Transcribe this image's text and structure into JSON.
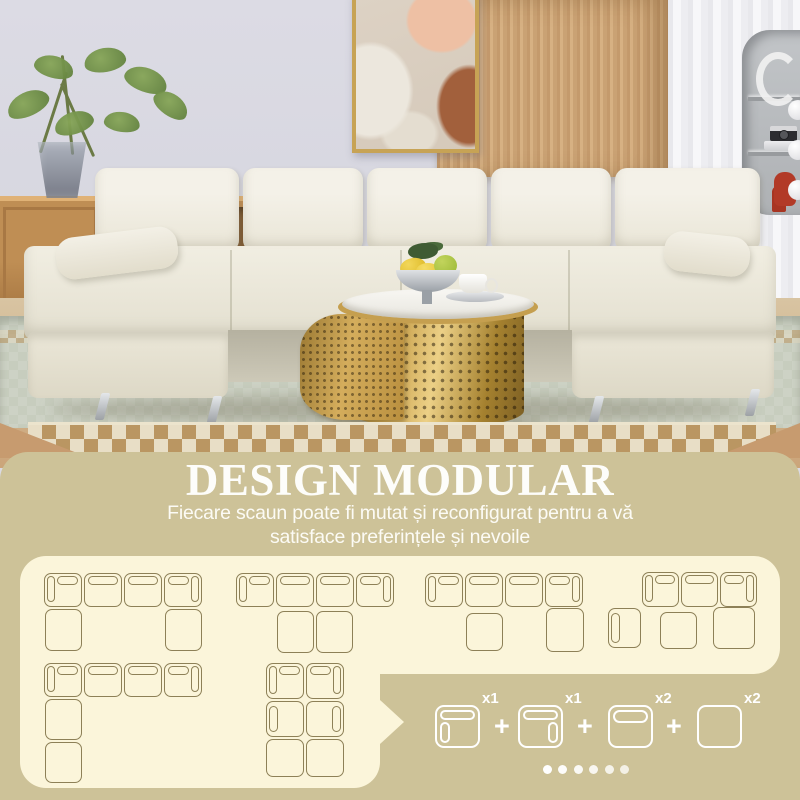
{
  "section": {
    "title": "DESIGN MODULAR",
    "subtitle_line1": "Fiecare scaun poate fi mutat și reconfigurat pentru a vă",
    "subtitle_line2": "satisface preferințele și nevoile"
  },
  "colors": {
    "panel_background": "#cdc298",
    "card_background": "#fbf5da",
    "diagram_outline": "#8d8057",
    "text_white": "#ffffff",
    "table_gold": "#caa34f",
    "sofa_fabric": "#efebdd"
  },
  "modular_configs": [
    {
      "label": "u-shape-4-seats-2-chaises",
      "pieces": [
        {
          "t": "sl",
          "x": 44,
          "y": 573,
          "w": 38,
          "h": 34
        },
        {
          "t": "s",
          "x": 84,
          "y": 573,
          "w": 38,
          "h": 34
        },
        {
          "t": "s",
          "x": 124,
          "y": 573,
          "w": 38,
          "h": 34
        },
        {
          "t": "sr",
          "x": 164,
          "y": 573,
          "w": 38,
          "h": 34
        },
        {
          "t": "o",
          "x": 45,
          "y": 609,
          "w": 37,
          "h": 42
        },
        {
          "t": "o",
          "x": 165,
          "y": 609,
          "w": 37,
          "h": 42
        }
      ]
    },
    {
      "label": "sofa-4-seats-center-ottomans",
      "pieces": [
        {
          "t": "sl",
          "x": 236,
          "y": 573,
          "w": 38,
          "h": 34
        },
        {
          "t": "s",
          "x": 276,
          "y": 573,
          "w": 38,
          "h": 34
        },
        {
          "t": "s",
          "x": 316,
          "y": 573,
          "w": 38,
          "h": 34
        },
        {
          "t": "sr",
          "x": 356,
          "y": 573,
          "w": 38,
          "h": 34
        },
        {
          "t": "o",
          "x": 277,
          "y": 611,
          "w": 37,
          "h": 42
        },
        {
          "t": "o",
          "x": 316,
          "y": 611,
          "w": 37,
          "h": 42
        }
      ]
    },
    {
      "label": "sofa-4-seats-offset-ottomans",
      "pieces": [
        {
          "t": "sl",
          "x": 425,
          "y": 573,
          "w": 38,
          "h": 34
        },
        {
          "t": "s",
          "x": 465,
          "y": 573,
          "w": 38,
          "h": 34
        },
        {
          "t": "s",
          "x": 505,
          "y": 573,
          "w": 38,
          "h": 34
        },
        {
          "t": "sr",
          "x": 545,
          "y": 573,
          "w": 38,
          "h": 34
        },
        {
          "t": "o",
          "x": 466,
          "y": 613,
          "w": 37,
          "h": 38
        },
        {
          "t": "o",
          "x": 546,
          "y": 608,
          "w": 38,
          "h": 44
        }
      ]
    },
    {
      "label": "sofa-3-seats-side-and-ottomans",
      "pieces": [
        {
          "t": "sl",
          "x": 642,
          "y": 572,
          "w": 37,
          "h": 35
        },
        {
          "t": "s",
          "x": 681,
          "y": 572,
          "w": 37,
          "h": 35
        },
        {
          "t": "sr",
          "x": 720,
          "y": 572,
          "w": 37,
          "h": 35
        },
        {
          "t": "al",
          "x": 608,
          "y": 608,
          "w": 33,
          "h": 40
        },
        {
          "t": "o",
          "x": 660,
          "y": 612,
          "w": 37,
          "h": 37
        },
        {
          "t": "o",
          "x": 713,
          "y": 607,
          "w": 42,
          "h": 42
        }
      ]
    },
    {
      "label": "l-shape-long-chaise",
      "pieces": [
        {
          "t": "sl",
          "x": 44,
          "y": 663,
          "w": 38,
          "h": 34
        },
        {
          "t": "s",
          "x": 84,
          "y": 663,
          "w": 38,
          "h": 34
        },
        {
          "t": "s",
          "x": 124,
          "y": 663,
          "w": 38,
          "h": 34
        },
        {
          "t": "sr",
          "x": 164,
          "y": 663,
          "w": 38,
          "h": 34
        },
        {
          "t": "o",
          "x": 45,
          "y": 699,
          "w": 37,
          "h": 41
        },
        {
          "t": "o",
          "x": 45,
          "y": 742,
          "w": 37,
          "h": 41
        }
      ]
    },
    {
      "label": "double-chaise-block",
      "pieces": [
        {
          "t": "sl",
          "x": 266,
          "y": 663,
          "w": 38,
          "h": 36
        },
        {
          "t": "sr",
          "x": 306,
          "y": 663,
          "w": 38,
          "h": 36
        },
        {
          "t": "al",
          "x": 266,
          "y": 701,
          "w": 38,
          "h": 36
        },
        {
          "t": "ar",
          "x": 306,
          "y": 701,
          "w": 38,
          "h": 36
        },
        {
          "t": "o",
          "x": 266,
          "y": 739,
          "w": 38,
          "h": 38
        },
        {
          "t": "o",
          "x": 306,
          "y": 739,
          "w": 38,
          "h": 38
        }
      ]
    }
  ],
  "parts_list": {
    "plus_symbol": "+",
    "items": [
      {
        "icon": "seat-left-armrest-icon",
        "t": "lp",
        "qty": "x1",
        "x": 435
      },
      {
        "icon": "seat-right-armrest-icon",
        "t": "rp",
        "qty": "x1",
        "x": 518
      },
      {
        "icon": "seat-backrest-icon",
        "t": "bp",
        "qty": "x2",
        "x": 608
      },
      {
        "icon": "ottoman-icon",
        "t": "pl",
        "qty": "x2",
        "x": 697
      }
    ],
    "plus_x": [
      494,
      577,
      666
    ]
  },
  "carousel": {
    "dot_count": 6,
    "active_index": 0,
    "start_x": 543,
    "step": 15.4
  }
}
